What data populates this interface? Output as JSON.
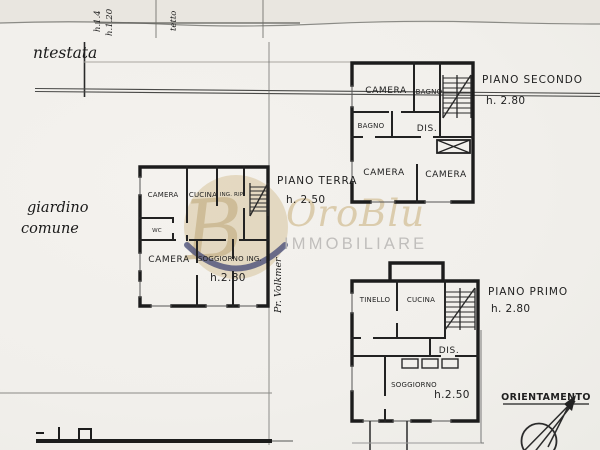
{
  "colors": {
    "ink": "#1f1f1f",
    "paper": "#f2f0ec",
    "watermark_beige": "#d8c6a0",
    "watermark_tan": "#c3ad82",
    "watermark_navy": "#3d4370",
    "watermark_gray": "#b6b4b1"
  },
  "watermark": {
    "brand_script": "OroBlu",
    "brand_sub": "IMMOBILIARE",
    "monogram": "B"
  },
  "handwritten": {
    "ntestata": "ntestata",
    "giardino_line1": "giardino",
    "giardino_line2": "comune",
    "volkmer": "Pr. Volkmer",
    "top_note1": "h.1.4",
    "top_note2": "h.1.20",
    "top_note3": "tetto"
  },
  "piano_secondo": {
    "title": "PIANO SECONDO",
    "height": "h. 2.80",
    "rooms": {
      "camera1": "CAMERA",
      "bagno1": "BAGNO",
      "bagno2": "BAGNO",
      "dis": "DIS.",
      "camera2": "CAMERA",
      "camera3": "CAMERA"
    }
  },
  "piano_terra": {
    "title": "PIANO TERRA",
    "height": "h. 2.50",
    "rooms": {
      "camera1": "CAMERA",
      "cucina": "CUCINA",
      "ing_rip": "ING. RIP.",
      "wc": "WC",
      "camera2": "CAMERA",
      "soggiorno": "SOGGIORNO ING.",
      "inner_height": "h.2.80"
    }
  },
  "piano_primo": {
    "title": "PIANO PRIMO",
    "height": "h. 2.80",
    "rooms": {
      "tinello": "TINELLO",
      "cucina": "CUCINA",
      "dis": "DIS.",
      "soggiorno": "SOGGIORNO",
      "inner_height": "h.2.50"
    }
  },
  "compass": {
    "label": "ORIENTAMENTO"
  }
}
